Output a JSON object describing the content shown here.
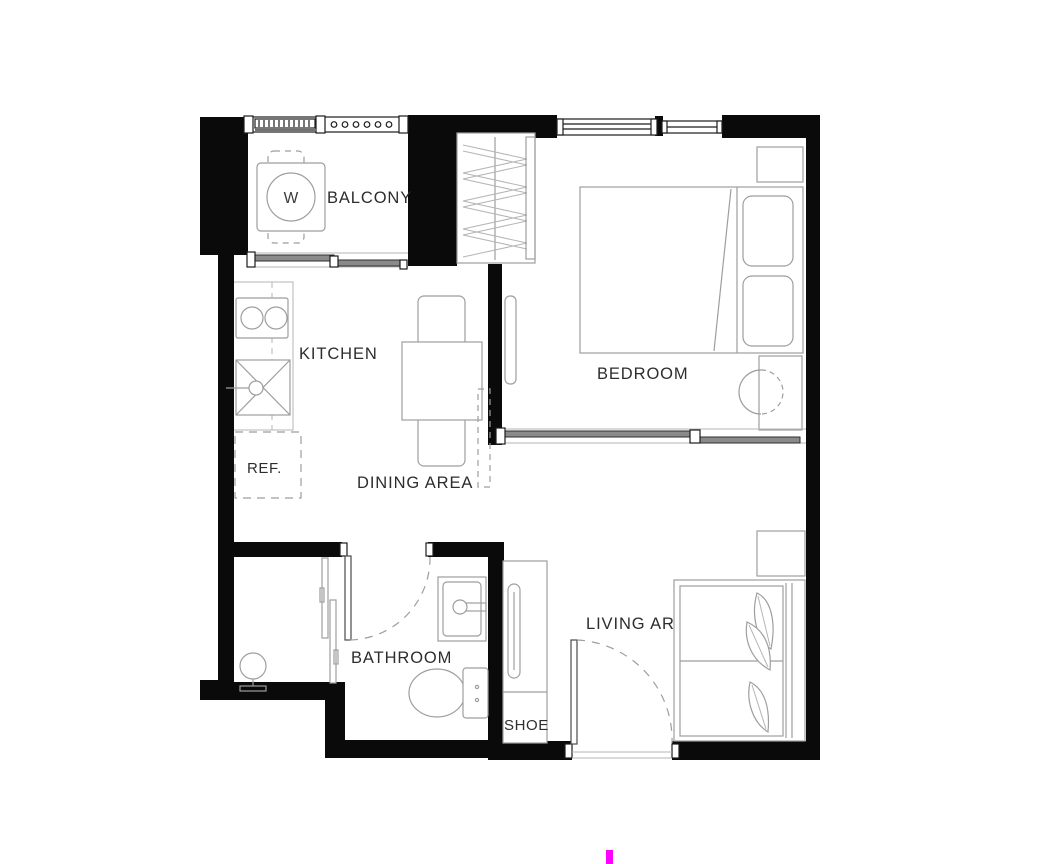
{
  "title": "one-bedroom-apartment-floor-plan",
  "colors": {
    "wall": "#0a0a0a",
    "furniture_line": "#9e9e9e",
    "text": "#2d2d2d",
    "slider_fill": "#8a8a8a",
    "cursor": "#ff00ff",
    "background": "#ffffff"
  },
  "rooms": {
    "balcony": {
      "label": "BALCONY"
    },
    "kitchen": {
      "label": "KITCHEN"
    },
    "dining": {
      "label": "DINING AREA"
    },
    "bedroom": {
      "label": "BEDROOM"
    },
    "bathroom": {
      "label": "BATHROOM"
    },
    "living": {
      "label": "LIVING AREA"
    },
    "shoe": {
      "label": "SHOE"
    },
    "refrigerator": {
      "label": "REF."
    },
    "washer": {
      "label": "W"
    }
  }
}
